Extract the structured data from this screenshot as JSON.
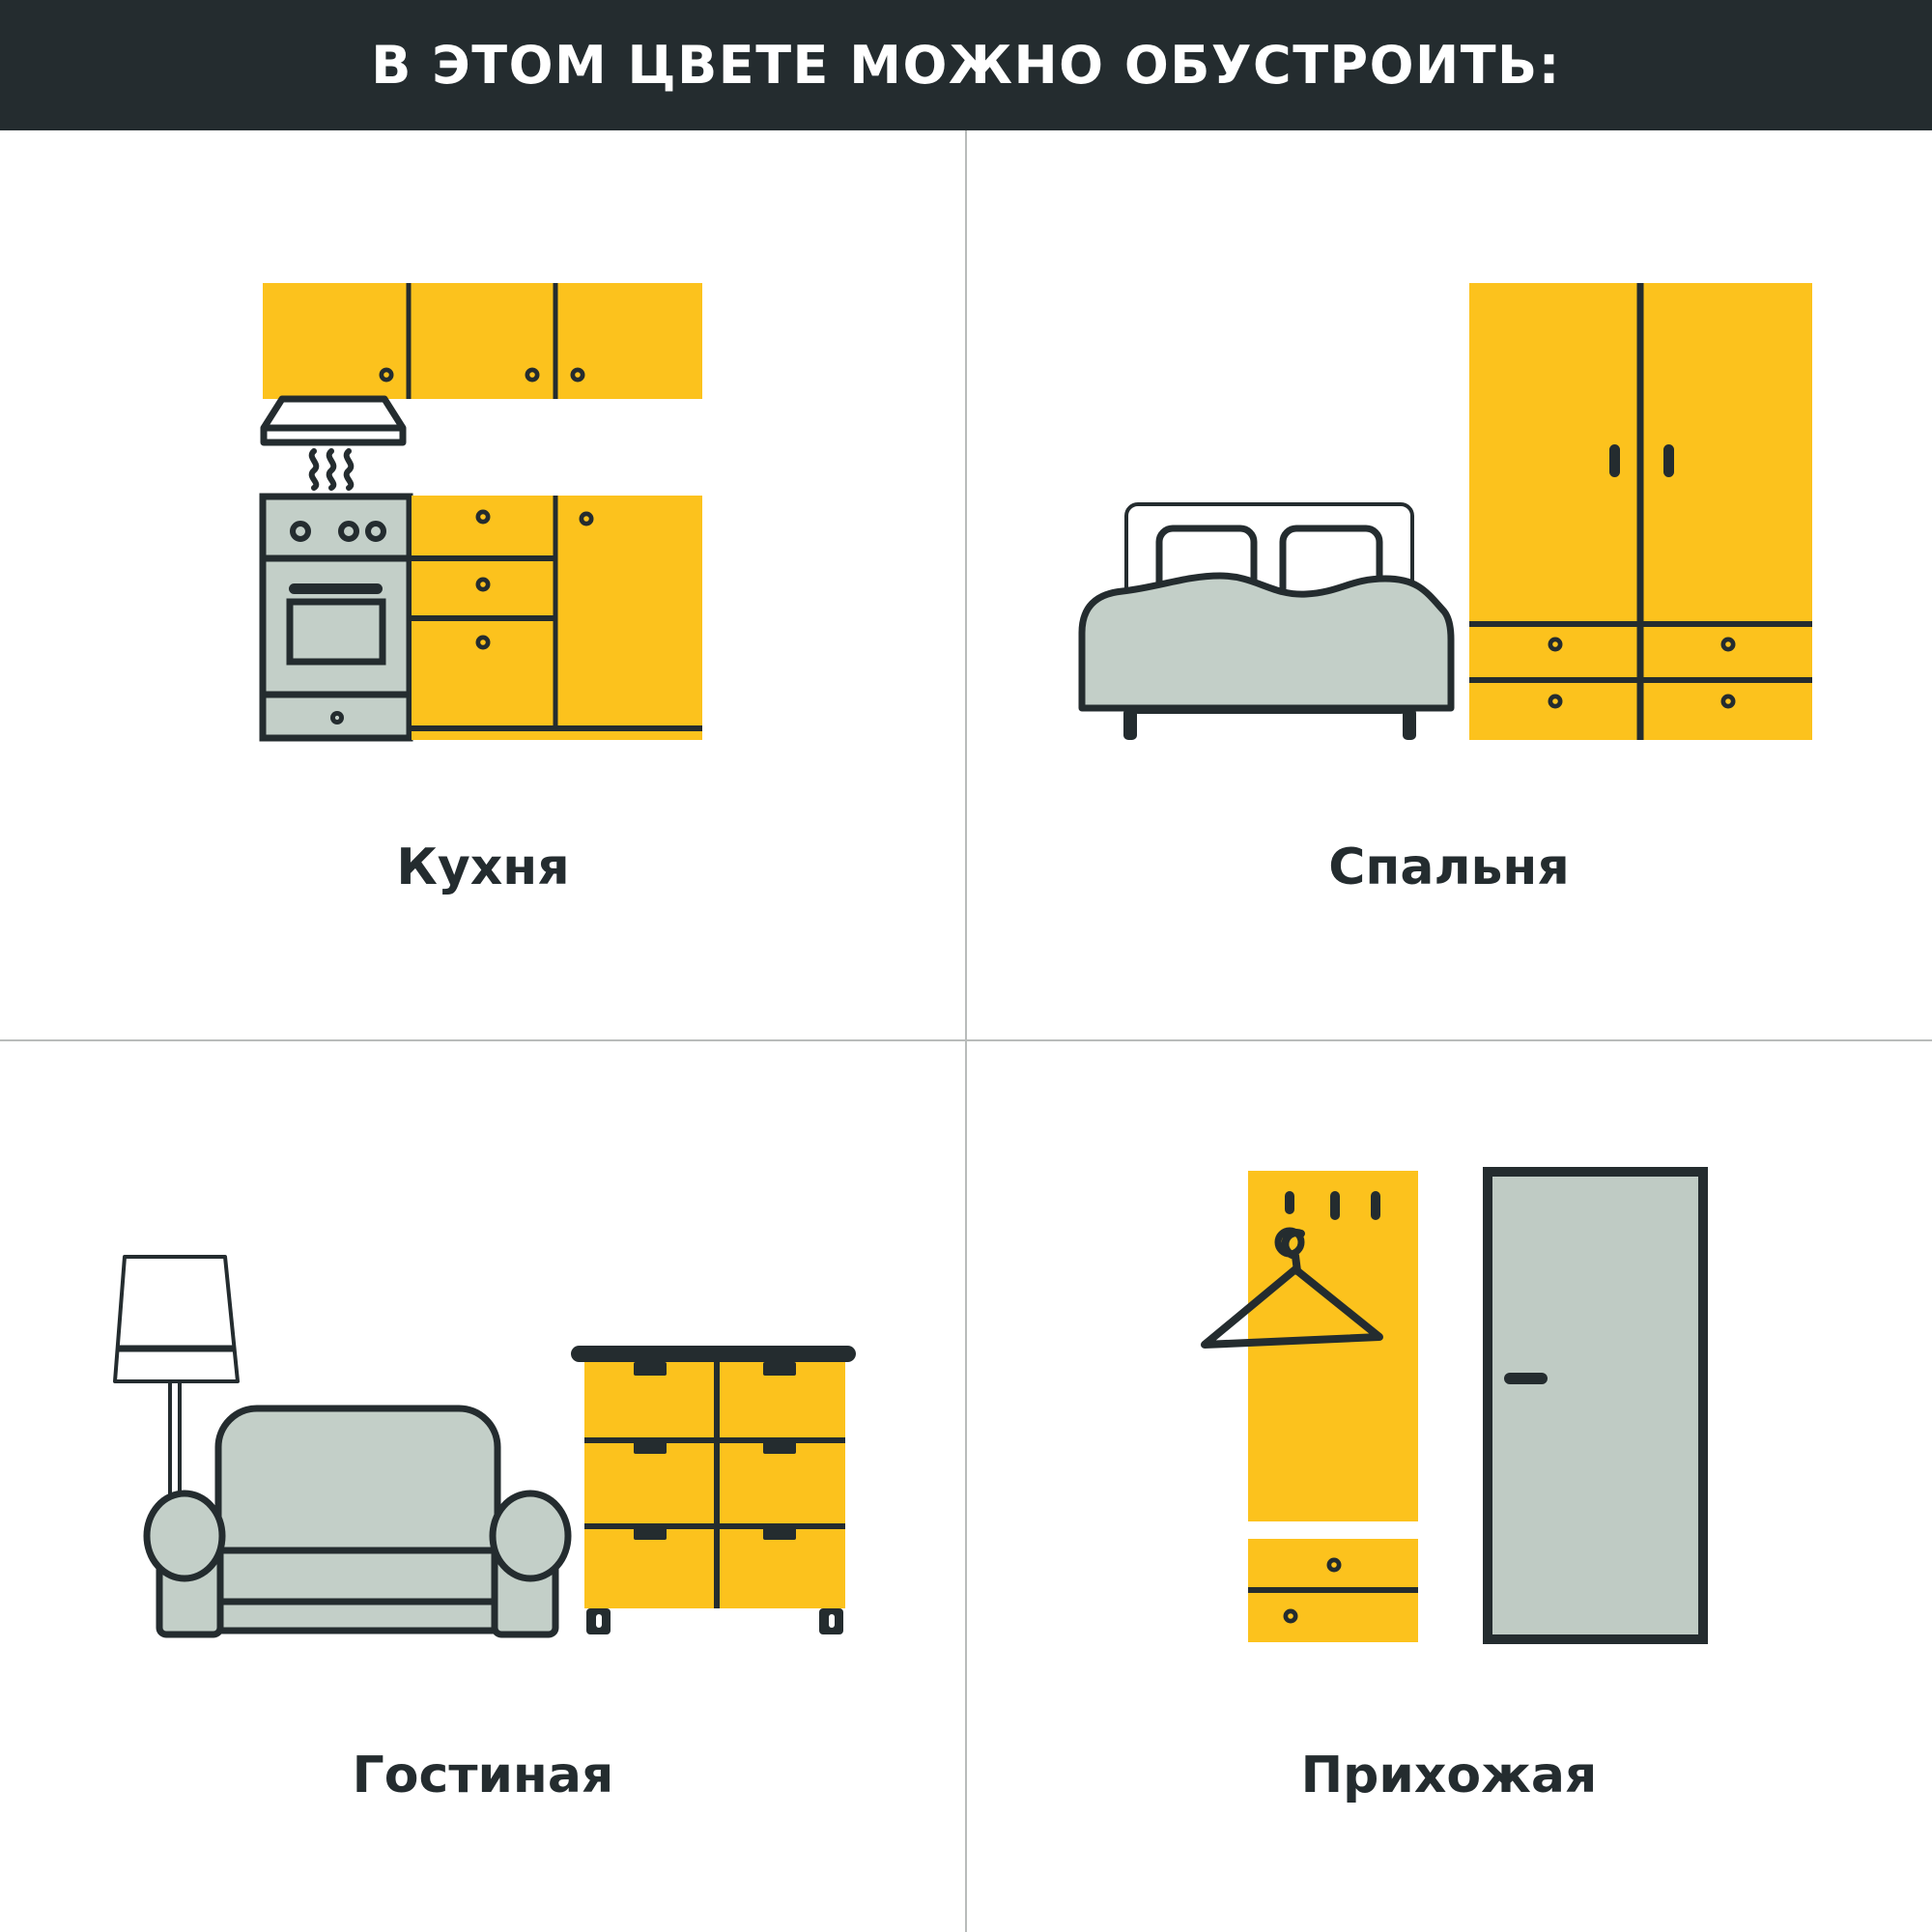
{
  "header": {
    "title": "В ЭТОМ ЦВЕТЕ МОЖНО ОБУСТРОИТЬ:"
  },
  "quadrants": [
    {
      "id": "kitchen",
      "label": "Кухня",
      "icon": "kitchen-illustration"
    },
    {
      "id": "bedroom",
      "label": "Спальня",
      "icon": "bedroom-illustration"
    },
    {
      "id": "living-room",
      "label": "Гостиная",
      "icon": "living-room-illustration"
    },
    {
      "id": "hallway",
      "label": "Прихожая",
      "icon": "hallway-illustration"
    }
  ],
  "icons": [
    "kitchen-cabinets-icon",
    "range-hood-icon",
    "stove-icon",
    "oven-icon",
    "bed-icon",
    "pillow-icon",
    "wardrobe-icon",
    "floor-lamp-icon",
    "sofa-icon",
    "chest-of-drawers-icon",
    "coat-hanger-icon",
    "wall-hooks-icon",
    "shoe-cabinet-icon",
    "door-icon"
  ],
  "colors": {
    "accent_yellow": "#FCC21D",
    "outline_dark": "#242C2F",
    "furniture_gray": "#C3CFC8",
    "door_gray": "#BFCBC4",
    "header_background": "#242C2F",
    "grid_line": "#B9BCBB",
    "background": "#FFFFFF"
  }
}
